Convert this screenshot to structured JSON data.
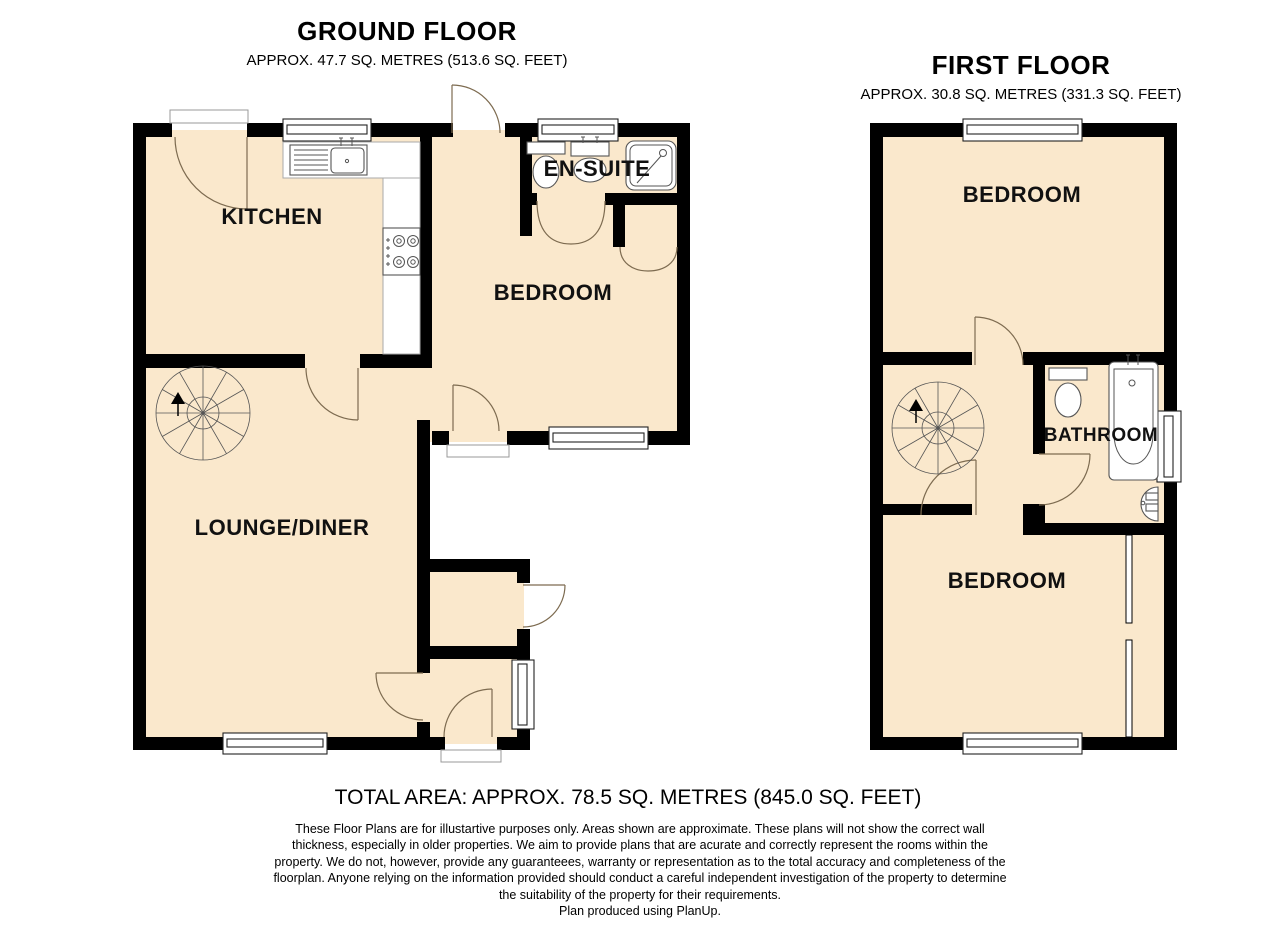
{
  "ground_floor": {
    "title": "GROUND FLOOR",
    "area": "APPROX. 47.7 SQ. METRES (513.6 SQ. FEET)",
    "rooms": {
      "kitchen": "KITCHEN",
      "bedroom": "BEDROOM",
      "ensuite": "EN-SUITE",
      "lounge": "LOUNGE/DINER"
    }
  },
  "first_floor": {
    "title": "FIRST FLOOR",
    "area": "APPROX. 30.8 SQ. METRES (331.3 SQ. FEET)",
    "rooms": {
      "bedroom_front": "BEDROOM",
      "bathroom": "BATHROOM",
      "bedroom_back": "BEDROOM"
    }
  },
  "summary": {
    "total_area": "TOTAL AREA: APPROX. 78.5 SQ. METRES (845.0 SQ. FEET)"
  },
  "disclaimer": {
    "lines": [
      "These Floor Plans are for illustartive purposes only. Areas shown are approximate. These plans will not show the correct wall",
      "thickness, especially in older properties. We aim to provide plans that are acurate and correctly represent the rooms within the",
      "property. We do not, however, provide any guaranteees, warranty or representation as to the total accuracy and completeness of the",
      "floorplan. Anyone relying on the information provided should conduct a careful independent investigation of the property to determine",
      "the suitability of the property for their requirements."
    ],
    "credit": "Plan produced using PlanUp."
  },
  "palette": {
    "floor": "#FAE8CC",
    "wall": "#000000",
    "door_arc": "#7D6B50",
    "fixture": "#555555",
    "background": "#FFFFFF"
  }
}
